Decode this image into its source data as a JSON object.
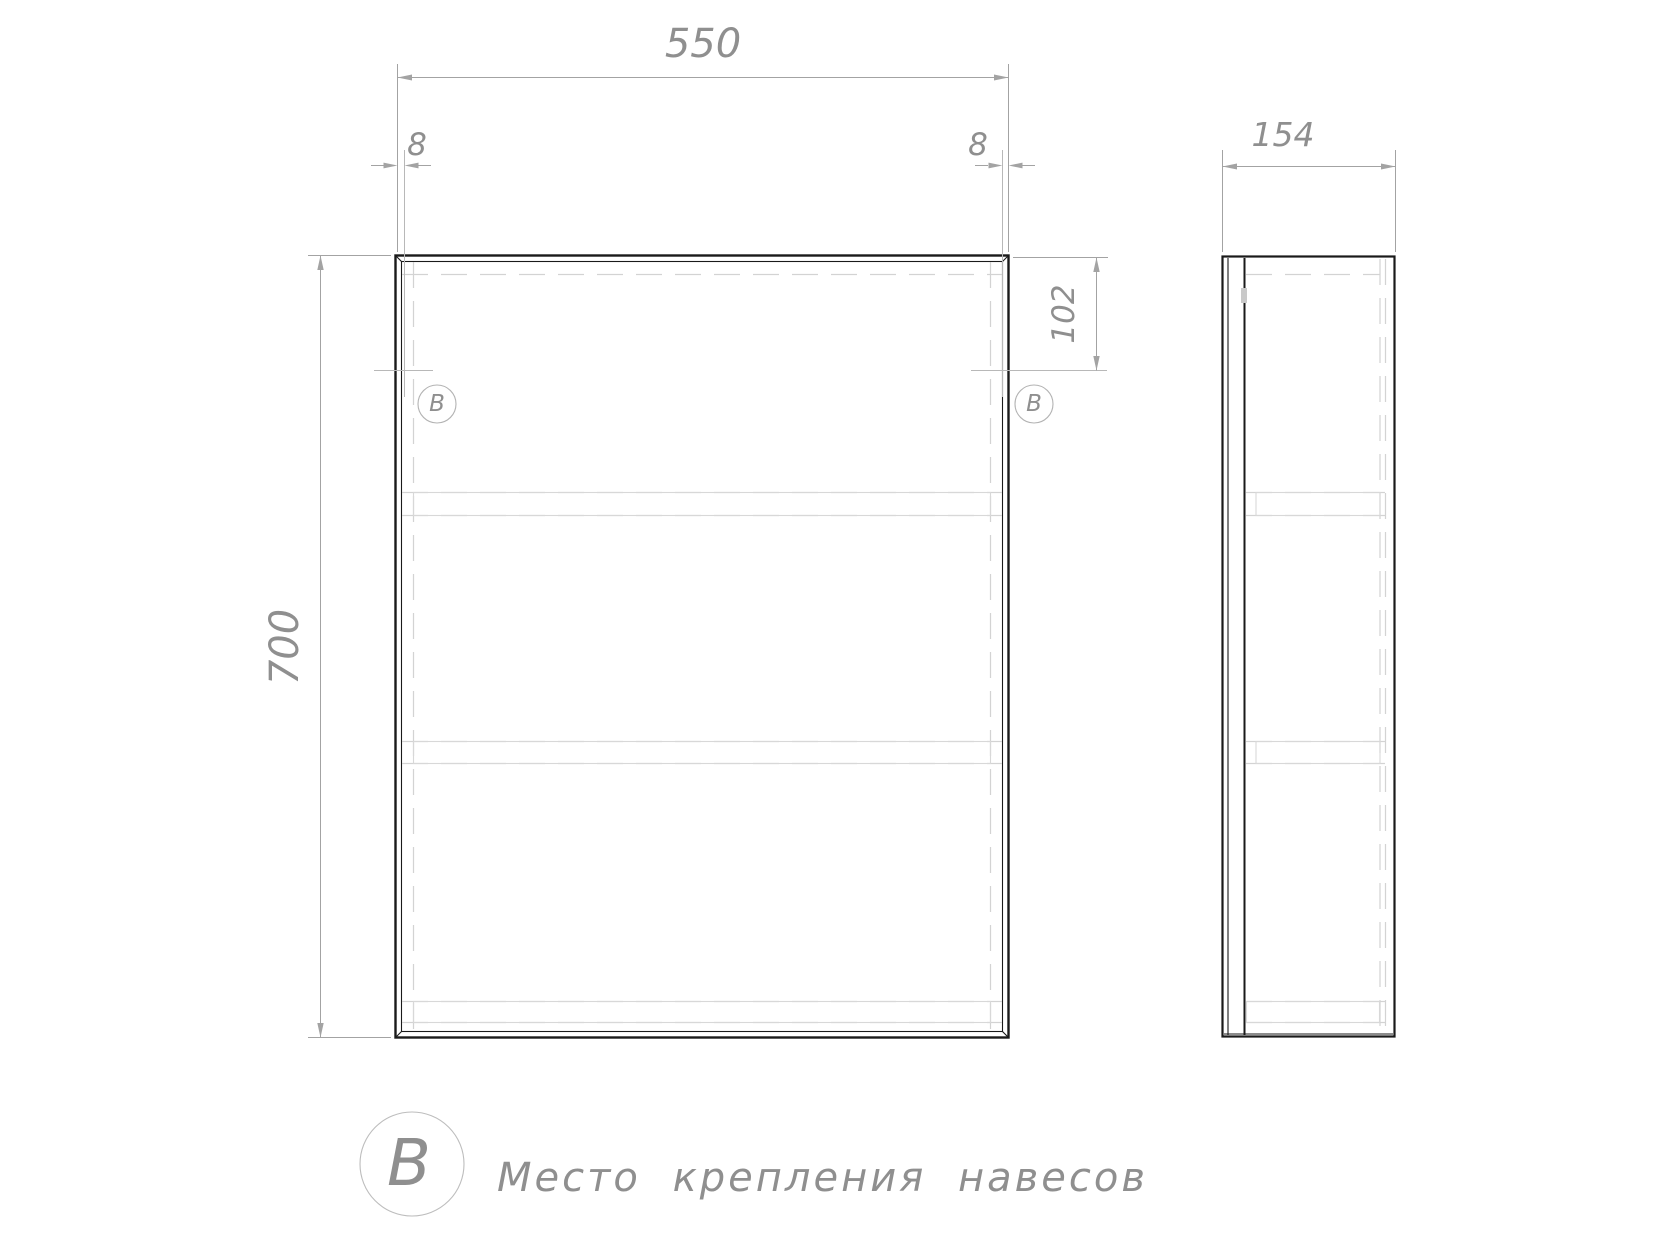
{
  "drawing": {
    "title": "Схема шкафа-зеркала",
    "front_view": {
      "width_dim": "550",
      "left_edge_offset_dim": "8",
      "right_edge_offset_dim": "8",
      "height_dim": "700",
      "mount_top_offset_dim": "102",
      "mount_marker_left": "В",
      "mount_marker_right": "В"
    },
    "side_view": {
      "depth_dim": "154"
    },
    "legend": {
      "marker": "В",
      "label": "Место крепления навесов"
    },
    "colors": {
      "outline": "#1a1a1a",
      "dimension_line": "#a3a3a3",
      "dimension_text": "#8f8f8f",
      "hidden_line": "#d3d3d3",
      "mount_line": "#b8b8b8",
      "background": "#ffffff"
    }
  }
}
